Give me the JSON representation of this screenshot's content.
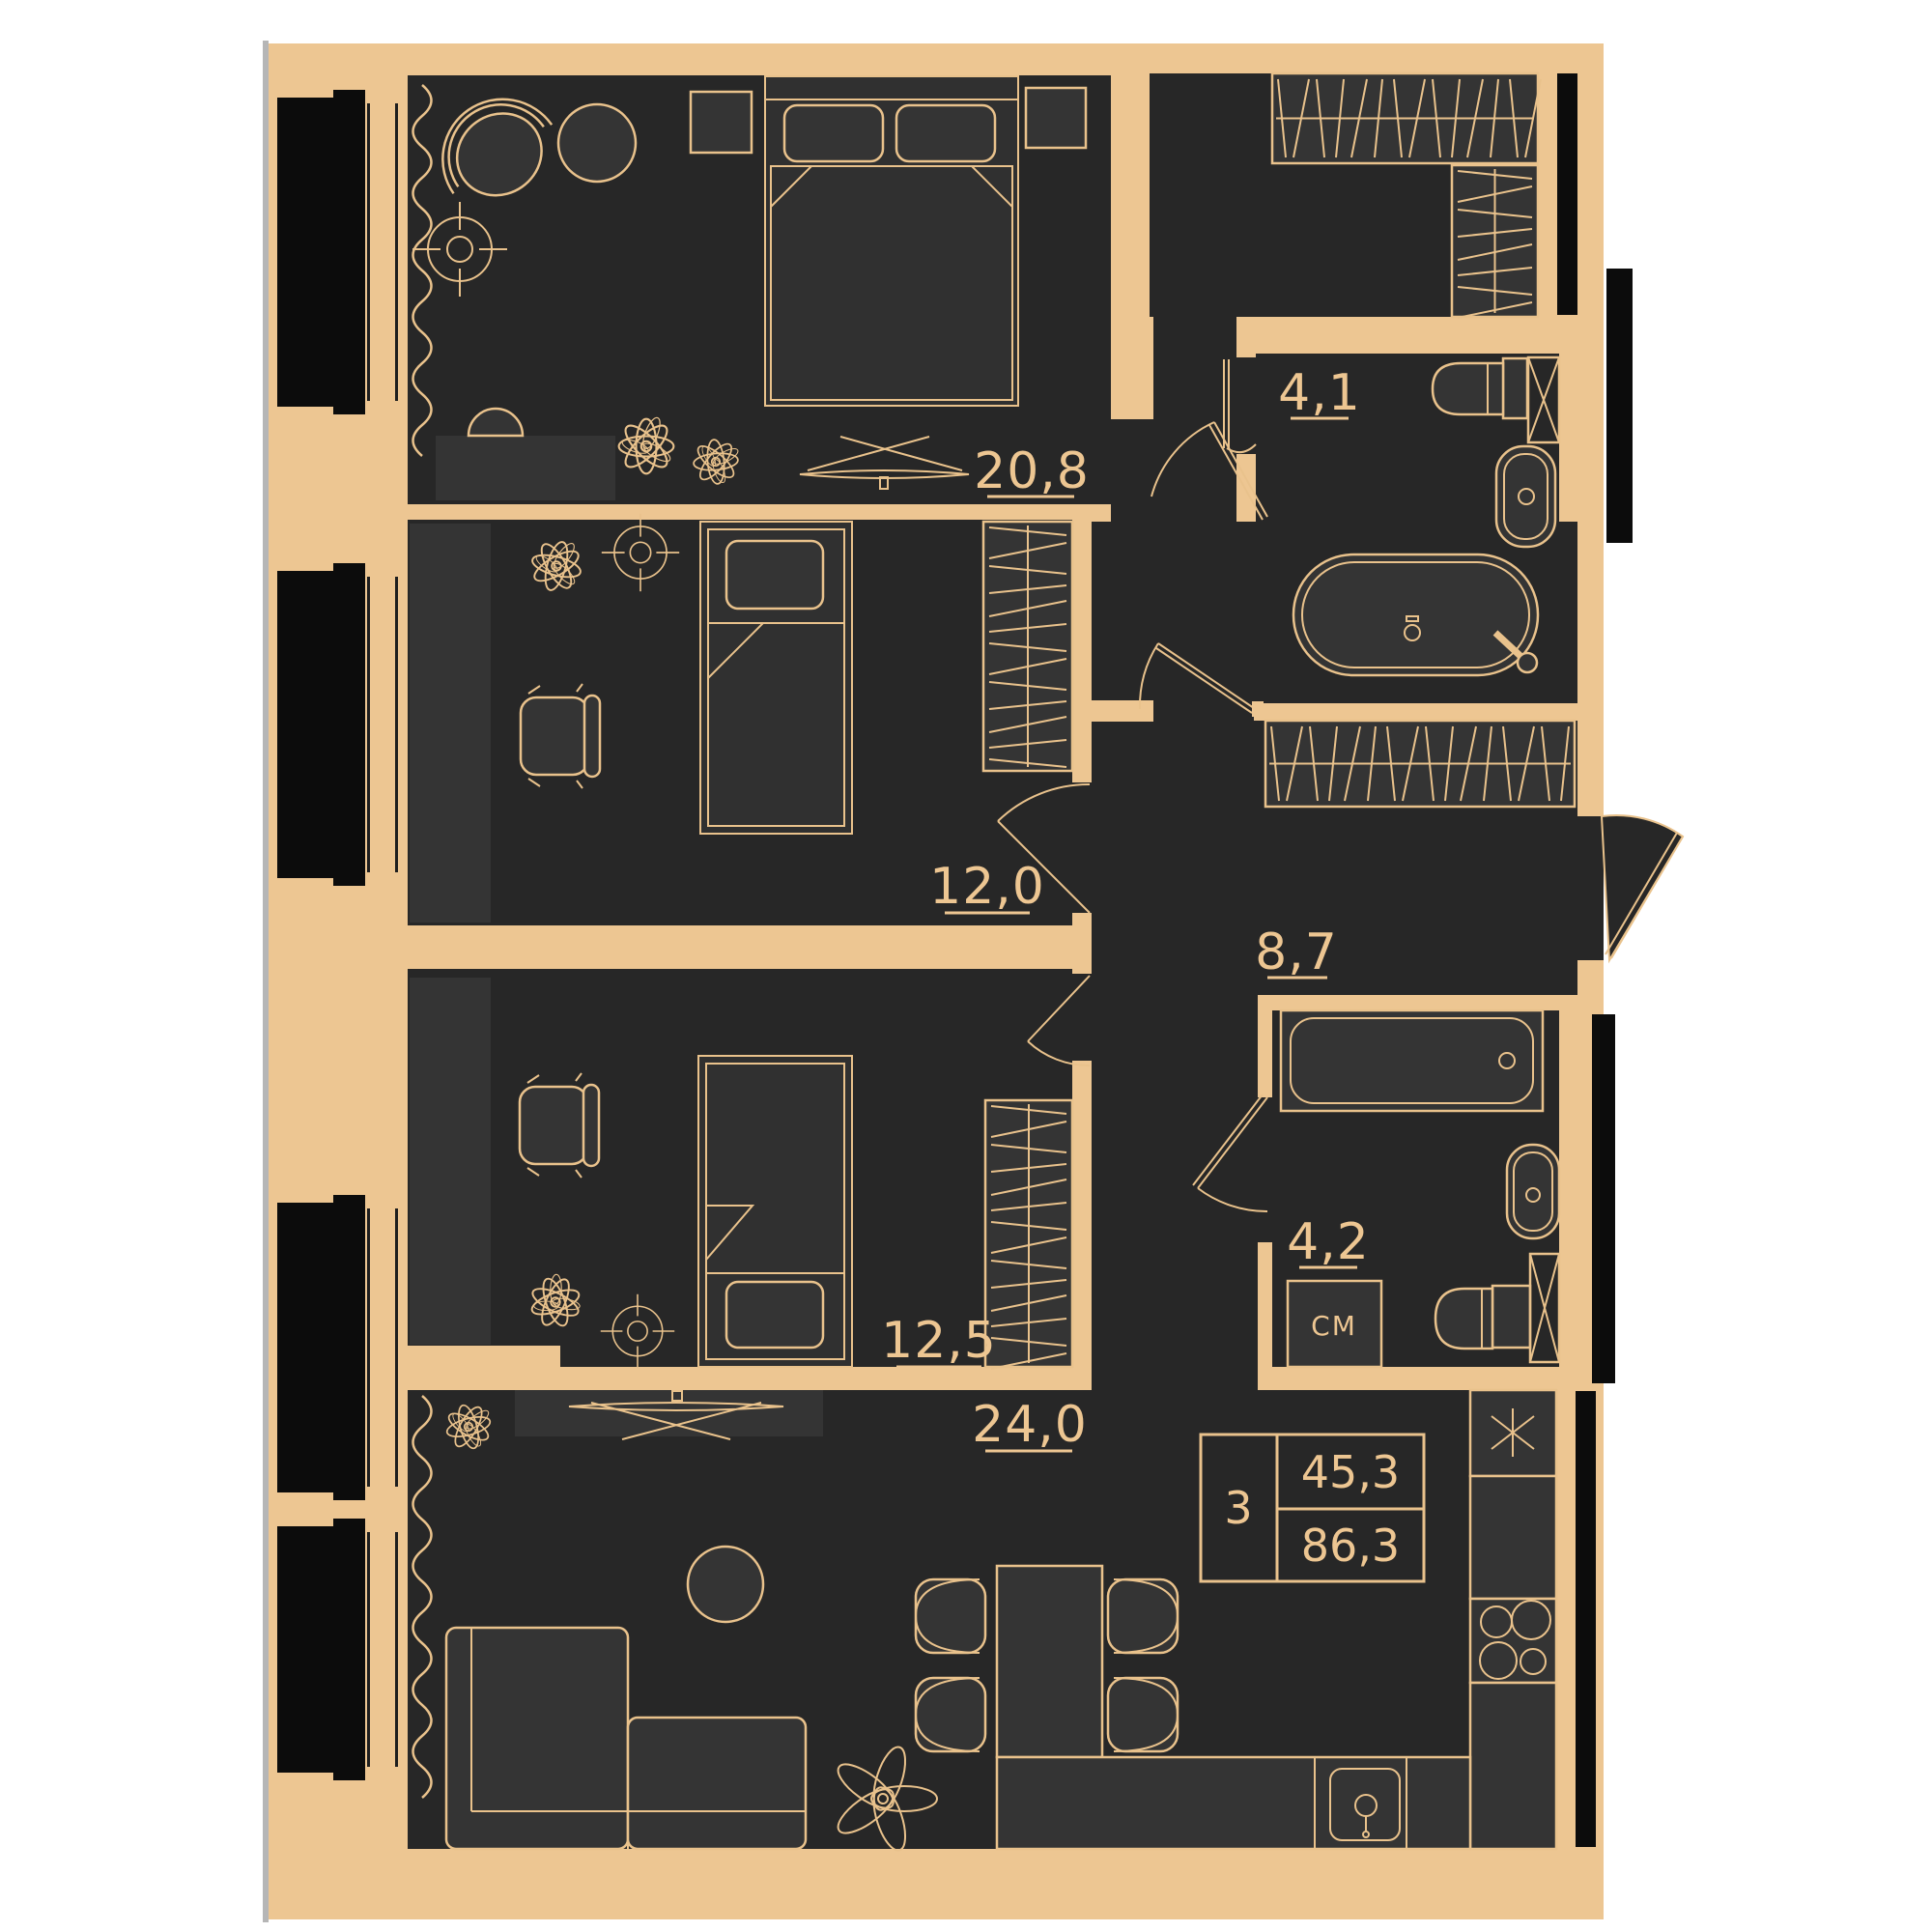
{
  "title": "3-room apartment floor plan",
  "colors": {
    "wall": "#edc692",
    "floor_dark": "#272727",
    "furniture": "#343434",
    "outline": "#e9c28c",
    "window_black": "#0c0c0c",
    "edge_grey": "#b6b6b6",
    "background": "#ffffff"
  },
  "labels": {
    "bedroom_area": "20,8",
    "child_room_1_area": "12,0",
    "child_room_2_area": "12,5",
    "living_kitchen_area": "24,0",
    "hallway_area": "8,7",
    "bathroom_1_area": "4,1",
    "bathroom_2_area": "4,2",
    "washing_machine": "СМ"
  },
  "summary": {
    "rooms_count": "3",
    "living_area": "45,3",
    "total_area": "86,3"
  }
}
